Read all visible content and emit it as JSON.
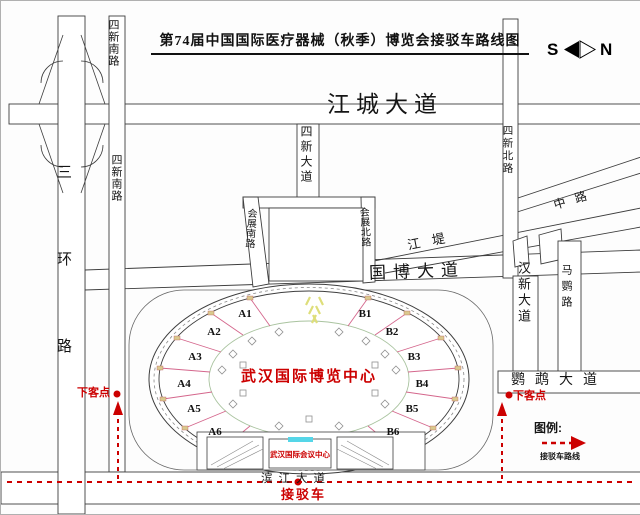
{
  "title": "第74届中国国际医疗器械（秋季）博览会接驳车路线图",
  "compass": {
    "south": "S",
    "north": "N"
  },
  "roads": {
    "jiangcheng": "江城大道",
    "sixin_south": "四新南路",
    "sanhuan": "三环路",
    "sixin_ave": "四新大道",
    "sixin_north": "四新北路",
    "zhong_lu": "中路",
    "jiangdi": "江堤",
    "guobo": "国博大道",
    "huizhan_south": "会展南路",
    "huizhan_north": "会展北路",
    "hanxin": "汉新大道",
    "maying": "马鹦路",
    "yingwu": "鹦鹉大道",
    "binjiang": "滨江大道"
  },
  "venue": {
    "expo": "武汉国际博览中心",
    "conference": "武汉国际会议中心"
  },
  "halls": {
    "a": [
      "A1",
      "A2",
      "A3",
      "A4",
      "A5",
      "A6"
    ],
    "b": [
      "B1",
      "B2",
      "B3",
      "B4",
      "B5",
      "B6"
    ]
  },
  "shuttle": {
    "dropoff": "下客点",
    "bus": "接驳车"
  },
  "legend": {
    "title": "图例:",
    "route": "接驳车路线"
  },
  "colors": {
    "route_red": "#cc0000",
    "road_line": "#3d3d3d",
    "hall_line": "#d4668c",
    "tick_tan": "#d9c98e",
    "highlight_cyan": "#55d6e8",
    "entrance_yellow": "#dede7a"
  }
}
